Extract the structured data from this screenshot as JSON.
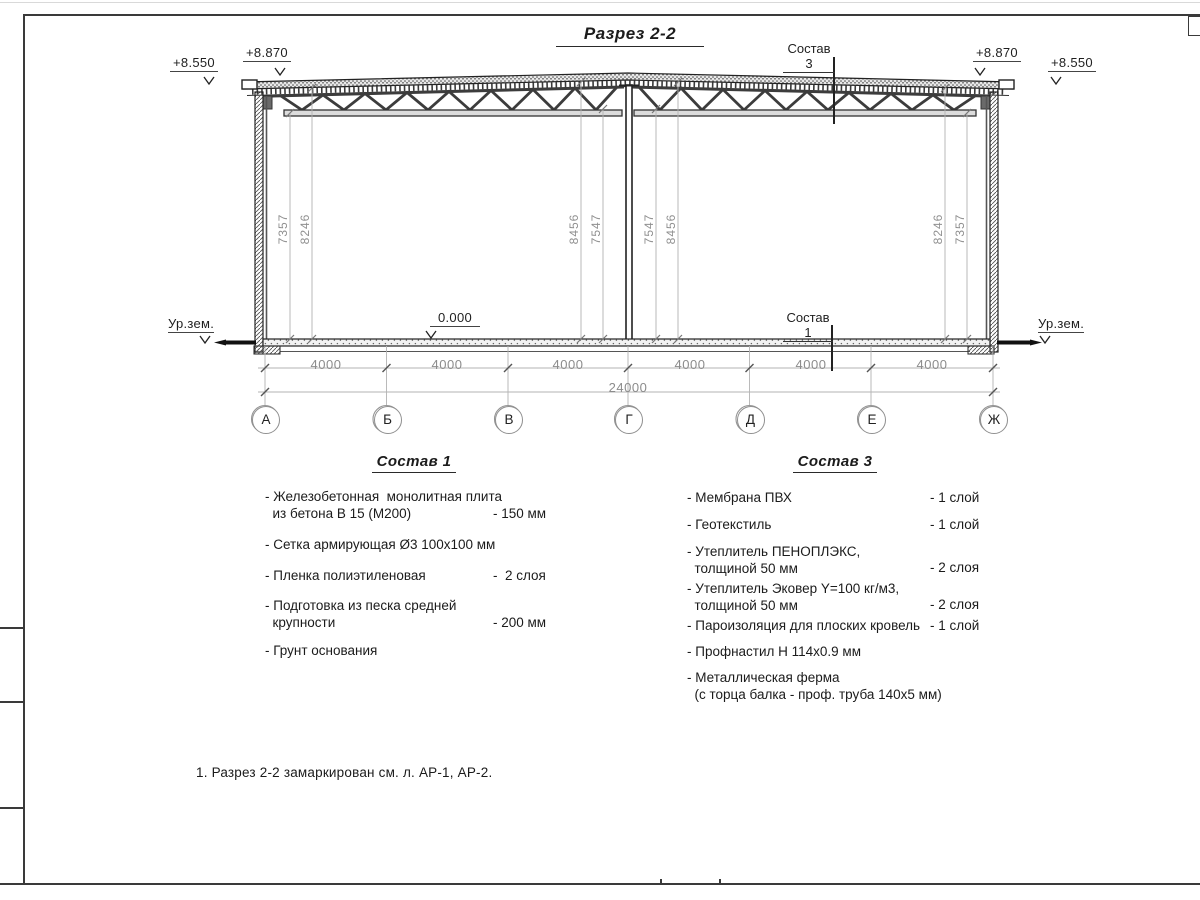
{
  "title": "Разрез 2-2",
  "elevations": {
    "left_outer": "+8.550",
    "left_wall": "+8.870",
    "right_wall": "+8.870",
    "right_outer": "+8.550",
    "zero": "0.000",
    "ground_left": "Ур.зем.",
    "ground_right": "Ур.зем."
  },
  "callouts": {
    "roof": "Состав 3",
    "floor": "Состав 1"
  },
  "vdims": [
    "7357",
    "8246",
    "8456",
    "7547",
    "7547",
    "8456",
    "8246",
    "7357"
  ],
  "dims": {
    "spans": [
      "4000",
      "4000",
      "4000",
      "4000",
      "4000",
      "4000"
    ],
    "total": "24000"
  },
  "axes": [
    "А",
    "Б",
    "В",
    "Г",
    "Д",
    "Е",
    "Ж"
  ],
  "comp1": {
    "heading": "Состав 1",
    "items": [
      {
        "text": "- Железобетонная  монолитная плита\n  из бетона В 15 (М200)",
        "value": "- 150 мм"
      },
      {
        "text": "- Сетка армирующая Ø3 100х100 мм",
        "value": ""
      },
      {
        "text": "- Пленка полиэтиленовая",
        "value": "-  2 слоя"
      },
      {
        "text": "- Подготовка из песка средней\n  крупности",
        "value": "- 200 мм"
      },
      {
        "text": "- Грунт основания",
        "value": ""
      }
    ]
  },
  "comp3": {
    "heading": "Состав 3",
    "items": [
      {
        "text": "- Мембрана ПВХ",
        "value": "- 1 слой"
      },
      {
        "text": "- Геотекстиль",
        "value": "- 1 слой"
      },
      {
        "text": "- Утеплитель ПЕНОПЛЭКС,\n  толщиной 50 мм",
        "value": "- 2 слоя"
      },
      {
        "text": "- Утеплитель Эковер Y=100 кг/м3,\n  толщиной 50 мм",
        "value": "- 2 слоя"
      },
      {
        "text": "- Пароизоляция для плоских кровель",
        "value": "- 1 слой"
      },
      {
        "text": "- Профнастил Н 114х0.9 мм",
        "value": ""
      },
      {
        "text": "- Металлическая ферма\n  (с торца балка - проф. труба 140х5 мм)",
        "value": ""
      }
    ]
  },
  "note": "1. Разрез 2-2 замаркирован см. л. АР-1, АР-2."
}
